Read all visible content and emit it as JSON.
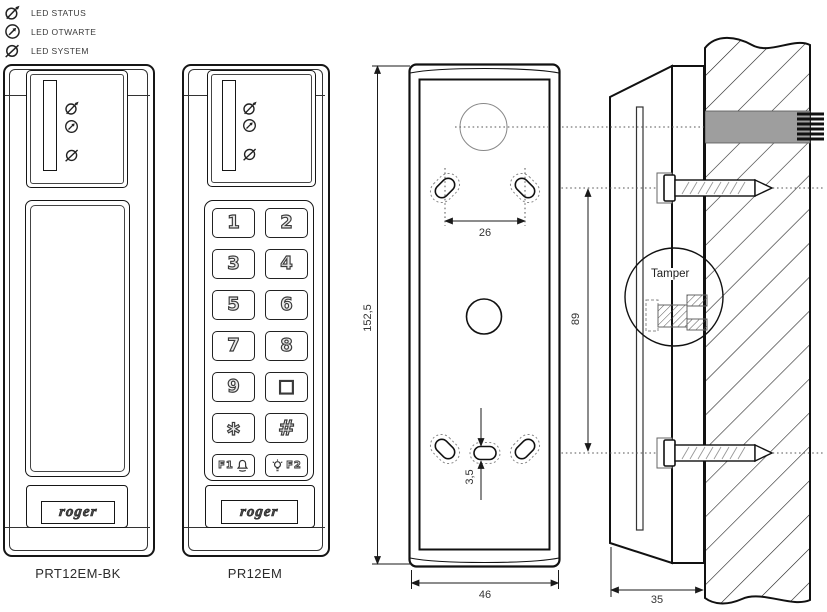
{
  "legend": {
    "items": [
      {
        "icon": "led-status-icon",
        "label": "LED STATUS"
      },
      {
        "icon": "led-open-icon",
        "label": "LED OTWARTE"
      },
      {
        "icon": "led-system-icon",
        "label": "LED SYSTEM"
      }
    ]
  },
  "devices": {
    "reader": {
      "caption": "PRT12EM-BK",
      "logo": "roger"
    },
    "keypad_reader": {
      "caption": "PR12EM",
      "logo": "roger"
    }
  },
  "keypad": {
    "keys": [
      "1",
      "2",
      "3",
      "4",
      "5",
      "6",
      "7",
      "8",
      "9",
      "□",
      "∗",
      "#"
    ],
    "function_keys": [
      {
        "label": "F1",
        "icon": "bell-icon"
      },
      {
        "label": "F2",
        "icon": "bulb-icon"
      }
    ]
  },
  "rear_view": {
    "dimensions": {
      "height": "152,5",
      "width": "46",
      "hole_spacing_h": "26",
      "hole_spacing_v": "89",
      "slot_width": "3,5"
    }
  },
  "side_view": {
    "depth": "35",
    "tamper_label": "Tamper"
  },
  "colors": {
    "line": "#1a1a1a",
    "conduit_gray": "#9e9e9e"
  }
}
